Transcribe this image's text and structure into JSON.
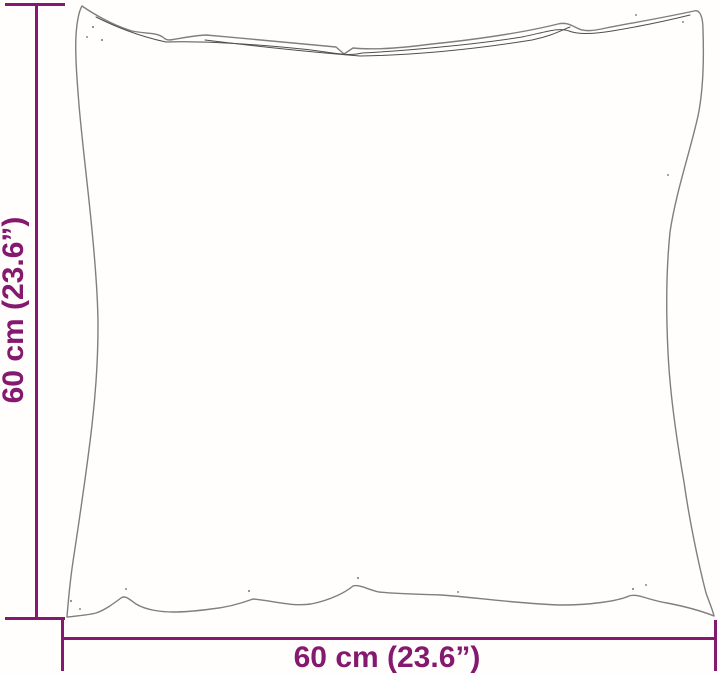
{
  "illustration": {
    "icon": "pillow-outline",
    "description_icon": "square-cushion-line-drawing"
  },
  "dimensions": {
    "height_label": "60 cm (23.6”)",
    "width_label": "60 cm (23.6”)"
  },
  "colors": {
    "accent": "#84196f",
    "outline": "#7f7f7f",
    "seam": "#4f4f4f",
    "bg": "#fffefd"
  }
}
